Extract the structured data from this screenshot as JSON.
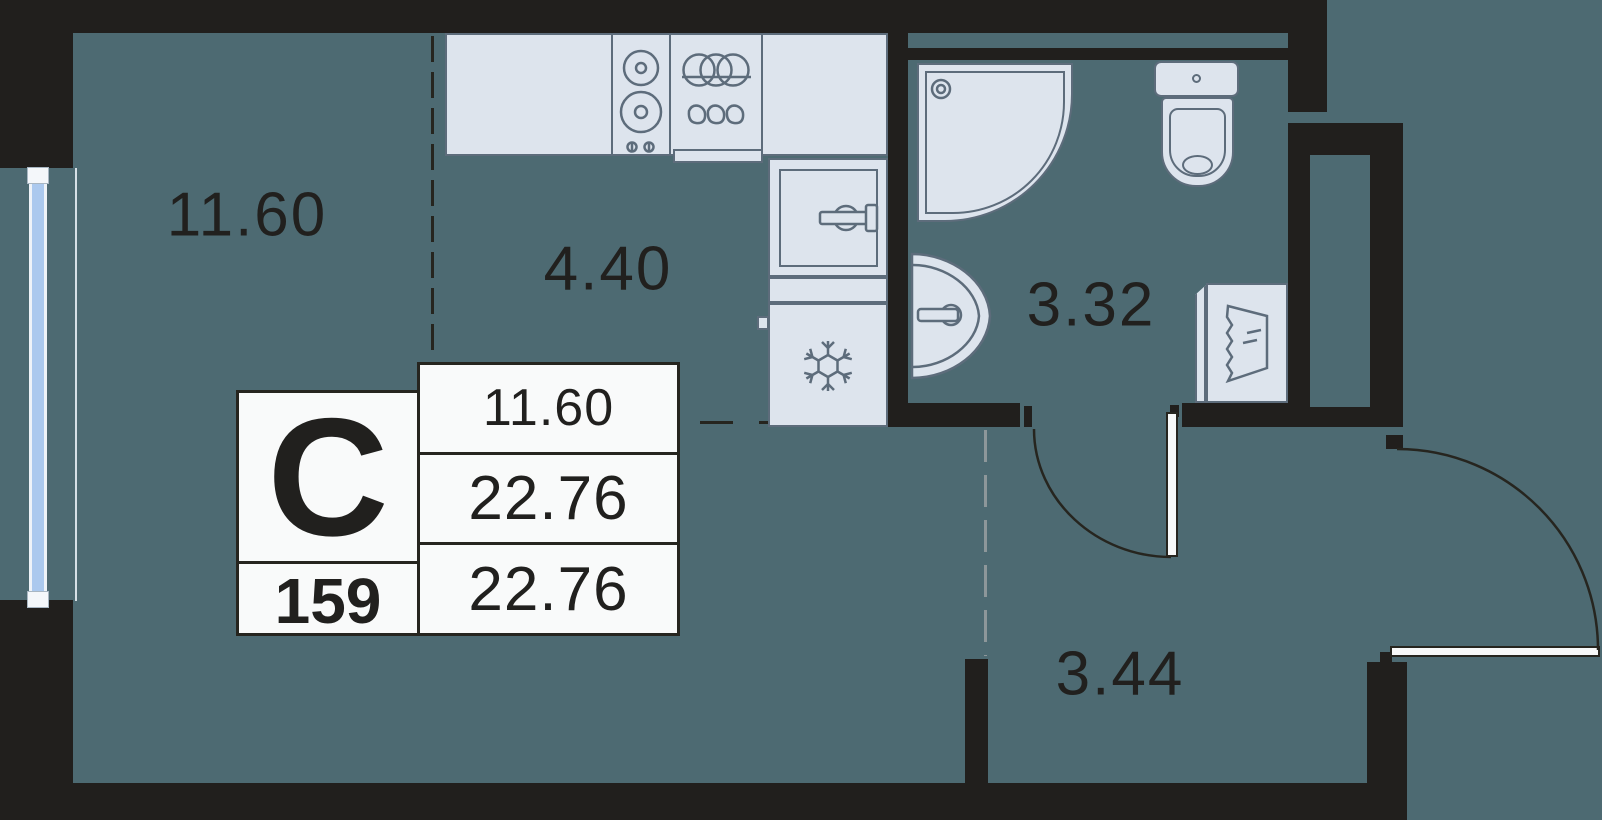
{
  "colors": {
    "floor": "#4d6a72",
    "wall": "#211f1d",
    "fixture_fill": "#dde4ed",
    "fixture_stroke": "#5d6c7b",
    "window_glass": "#abc9ee",
    "window_frame": "#eef3f8",
    "door_leaf": "#f8f9f9",
    "table_bg": "#f9fafa",
    "table_border": "#26251f",
    "text": "#21201e",
    "dash_dark": "#26251f",
    "dash_light": "#8d979a"
  },
  "rooms": {
    "living": {
      "area": "11.60"
    },
    "kitchen": {
      "area": "4.40"
    },
    "bathroom": {
      "area": "3.32"
    },
    "hallway": {
      "area": "3.44"
    }
  },
  "info_table": {
    "unit_type": "С",
    "unit_number": "159",
    "room_area": "11.60",
    "area_middle": "22.76",
    "total_area": "22.76"
  },
  "icons": {
    "snowflake-icon": "freezer / fridge symbol",
    "burner-icon": "two-ring hob symbol",
    "kitchen-sink-icon": "sink rings and drip symbol",
    "shower-drain-icon": "shower drain",
    "laundry-icon": "washing machine drum waves",
    "door-swing-arc": "door opening arc"
  }
}
